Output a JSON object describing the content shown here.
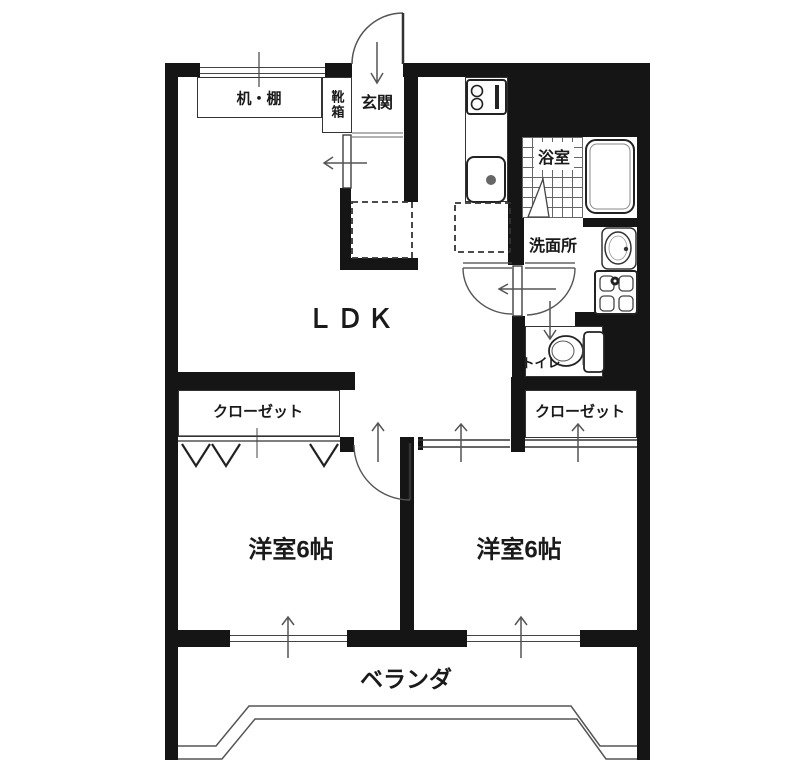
{
  "floorplan": {
    "labels": {
      "desk_shelf": "机・棚",
      "shoe_box": "靴箱",
      "entrance": "玄関",
      "bathroom": "浴室",
      "washroom": "洗面所",
      "toilet": "トイレ",
      "ldk": "ＬＤＫ",
      "closet_left": "クローゼット",
      "closet_right": "クローゼット",
      "bedroom_left": "洋室6帖",
      "bedroom_right": "洋室6帖",
      "veranda": "ベランダ"
    },
    "colors": {
      "wall": "#151515",
      "fixture_line": "#444444",
      "background": "#ffffff",
      "text": "#1a1a1a"
    }
  }
}
